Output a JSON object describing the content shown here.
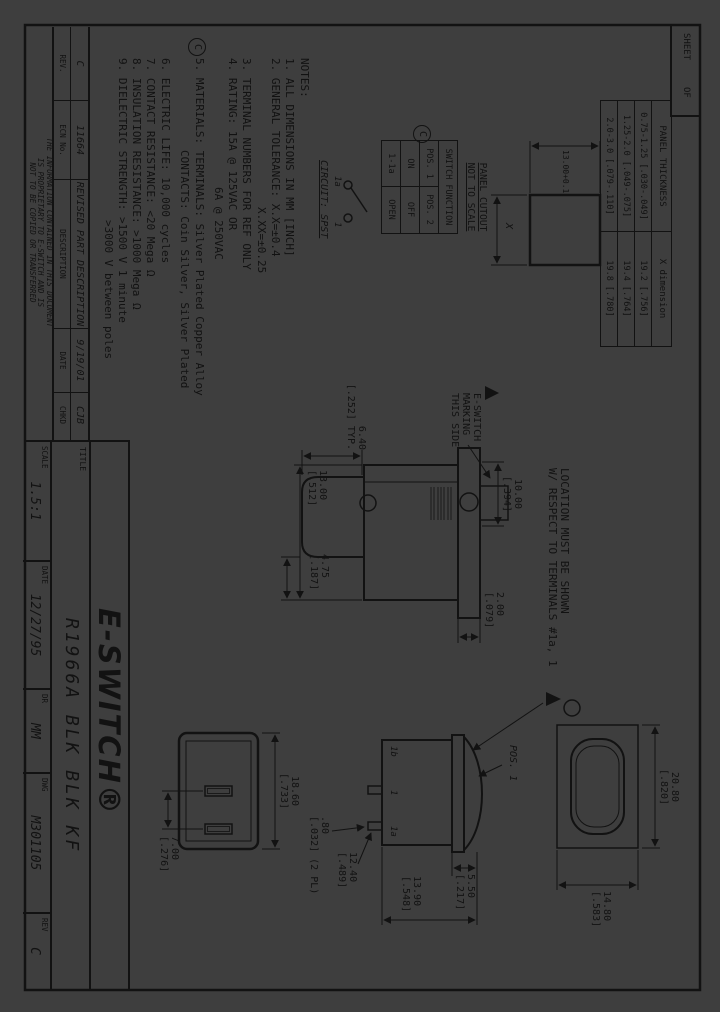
{
  "colors": {
    "background": "#3e3e3e",
    "ink": "#121212"
  },
  "sheet_box": {
    "sheet": "SHEET",
    "of": "OF"
  },
  "panel_table": {
    "headers": [
      "PANEL THICKNESS",
      "X dimension"
    ],
    "rows": [
      [
        "0.75-1.25 [.030-.049]",
        "19.2 [.756]"
      ],
      [
        "1.25-2.0 [.049-.075]",
        "19.4 [.764]"
      ],
      [
        "2.0-3.0 [.079-.110]",
        "19.8 [.780]"
      ]
    ]
  },
  "panel_cutout": {
    "dim_width": "13.00+0.1",
    "dim_x": "X",
    "label": "PANEL CUTOUT\nNOT TO SCALE"
  },
  "switch_function": {
    "title": "SWITCH FUNCTION",
    "rows": [
      [
        "POS. 1",
        "POS. 2"
      ],
      [
        "ON",
        "OFF"
      ],
      [
        "1-1a",
        "OPEN"
      ]
    ]
  },
  "circuit": {
    "terminal_a": "1a",
    "terminal_b": "1",
    "label": "CIRCUIT: SPST"
  },
  "revision_balloon": "C",
  "notes": {
    "lines": [
      "NOTES:",
      "1. ALL DIMENSIONS IN MM [INCH]",
      "2. GENERAL TOLERANCE: X.X=±0.4",
      "X.XX=±0.25",
      "3. TERMINAL NUMBERS FOR REF ONLY",
      "4. RATING: 15A @ 125VAC OR",
      "6A @ 250VAC",
      "5. MATERIALS: TERMINALS: Silver Plated Copper Alloy",
      "CONTACTS: Coin Silver, Silver Plated",
      "6. ELECTRIC LIFE: 10,000 cycles",
      "7. CONTACT RESISTANCE: <20 Mega Ω",
      "8. INSULATION RESISTANCE: >1000 Mega Ω",
      "9. DIELECTRIC STRENGTH: >1500 V 1 minute",
      ">3000 V between poles"
    ]
  },
  "annotations": {
    "marking": "E-SWITCH\nMARKING\nTHIS SIDE",
    "location": "LOCATION MUST BE SHOWN\nW/ RESPECT TO TERMINALS #1a, 1",
    "pos1": "POS. 1"
  },
  "dims": {
    "rocker_height": "6.40\n[.252] TYP.",
    "body_width": "13.00\n[.512]",
    "body_offset": "4.75\n[.187]",
    "bushing_width": "10.00\n[.394]",
    "flange_thickness": "2.00\n[.079]",
    "housing_length": "18.60\n[.733]",
    "terminal_spacing": "7.00\n[.276]",
    "bezel_height": "5.50\n[.217]",
    "total_height": "13.90\n[.548]",
    "terminal_length": "12.40\n[.489]",
    "terminal_thickness": ".80\n[.032] (2 PL)",
    "rocker_length": "20.80\n[.820]",
    "rocker_width": "14.80\n[.583]"
  },
  "side_terminals": {
    "t1": "1b",
    "t2": "1",
    "t3": "1a"
  },
  "revision_table": {
    "values": [
      "C",
      "11664",
      "REVISED PART DESCRIPTION",
      "9/19/01",
      "CJB"
    ],
    "labels": [
      "REV.",
      "ECN No.",
      "DESCRIPTION",
      "DATE",
      "CHKD"
    ]
  },
  "proprietary": "THE INFORMATION CONTAINED IN THIS DOCUMENT\nIS PROPRIETARY TO E-SWITCH AND IS\nNOT TO BE COPIED OR TRANSFERRED",
  "title_block": {
    "title_label": "TITLE",
    "logo": "E-SWITCH®",
    "title": "R1966A BLK BLK KF",
    "scale_label": "SCALE",
    "scale": "1.5:1",
    "date_label": "DATE",
    "date": "12/27/95",
    "dr_label": "DR",
    "dr": "MM",
    "dwg_label": "DWG",
    "dwg": "M301105",
    "rev_label": "REV",
    "rev": "C"
  }
}
